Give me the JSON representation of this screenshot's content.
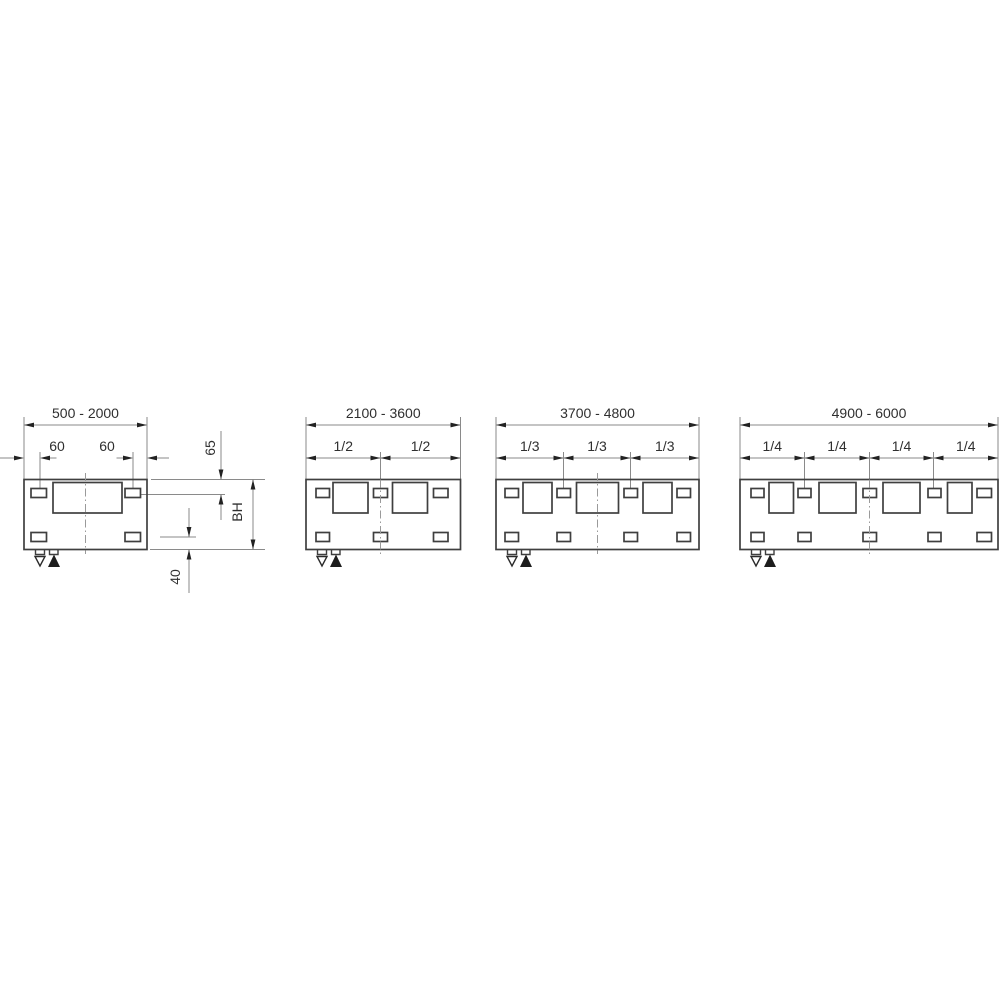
{
  "page": {
    "background": "#ffffff"
  },
  "style": {
    "geometry_color": "#3f3f3f",
    "dimension_line_color": "#8a8a8a",
    "arrow_color": "#222222",
    "text_color": "#2f2f2f",
    "centerline_color": "#9a9a9a"
  },
  "markers": {
    "open_down_triangle": "▽",
    "filled_up_triangle": "▲"
  },
  "diagrams": [
    {
      "name": "500-2000",
      "title": "500 - 2000",
      "plate": {
        "x1": 24,
        "x2": 147
      },
      "openings": [
        {
          "x": 53,
          "w": 69
        }
      ],
      "slots_top": [
        {
          "x": 31,
          "w": 15.5
        },
        {
          "x": 125,
          "w": 15.5
        }
      ],
      "slots_bottom": [
        {
          "x": 31,
          "w": 15.5
        },
        {
          "x": 125,
          "w": 15.5
        }
      ],
      "centerline_x": 85.5,
      "centerline_full": false,
      "boundaries": [],
      "span_labels": [],
      "offset_dim": {
        "labels": [
          "60",
          "60"
        ],
        "label_x": [
          57,
          107
        ],
        "verticals": [
          40,
          133
        ],
        "arrows": [
          {
            "dir": "right",
            "tip": 24,
            "tail": [
              0,
              14
            ]
          },
          {
            "dir": "left",
            "tip": 40,
            "tail": [
              50,
              56.5
            ]
          },
          {
            "dir": "right",
            "tip": 133,
            "tail": [
              116.5,
              123
            ]
          },
          {
            "dir": "left",
            "tip": 147,
            "tail": [
              157,
              169
            ]
          }
        ]
      },
      "side": {
        "ext_lines": [
          [
            151,
            479.5,
            265
          ],
          [
            141,
            494.5,
            225
          ],
          [
            160,
            537,
            196
          ],
          [
            150,
            549.5,
            265
          ]
        ],
        "dims": [
          {
            "label": "65",
            "x": 221,
            "text": [
              210,
              448
            ],
            "segs": [
              {
                "y1": 431,
                "y2": 479.5,
                "arrows": [
                  {
                    "dir": "down",
                    "y": 479.5
                  }
                ]
              },
              {
                "y1": 494.5,
                "y2": 520,
                "arrows": [
                  {
                    "dir": "up",
                    "y": 494.5
                  }
                ]
              }
            ]
          },
          {
            "label": "BH",
            "x": 253,
            "text": [
              237,
              512
            ],
            "segs": [
              {
                "y1": 479.5,
                "y2": 549.5,
                "arrows": [
                  {
                    "dir": "up",
                    "y": 479.5
                  },
                  {
                    "dir": "down",
                    "y": 549.5
                  }
                ]
              }
            ]
          },
          {
            "label": "40",
            "x": 189,
            "text": [
              175,
              577
            ],
            "segs": [
              {
                "y1": 508,
                "y2": 537,
                "arrows": [
                  {
                    "dir": "down",
                    "y": 537
                  }
                ]
              },
              {
                "y1": 549.5,
                "y2": 593,
                "arrows": [
                  {
                    "dir": "up",
                    "y": 549.5
                  }
                ]
              }
            ]
          }
        ]
      }
    },
    {
      "name": "2100-3600",
      "title": "2100 - 3600",
      "plate": {
        "x1": 306,
        "x2": 460.5
      },
      "openings": [
        {
          "x": 333,
          "w": 35
        },
        {
          "x": 392.5,
          "w": 35
        }
      ],
      "slots_top": [
        {
          "x": 316,
          "w": 13.5
        },
        {
          "x": 373.5,
          "w": 14
        },
        {
          "x": 433.5,
          "w": 14.5
        }
      ],
      "slots_bottom": [
        {
          "x": 316,
          "w": 13.5
        },
        {
          "x": 373.5,
          "w": 14
        },
        {
          "x": 433.5,
          "w": 14.5
        }
      ],
      "centerline_x": 380.5,
      "centerline_full": true,
      "boundaries": [
        380.5
      ],
      "span_labels": [
        "1/2",
        "1/2"
      ]
    },
    {
      "name": "3700-4800",
      "title": "3700 - 4800",
      "plate": {
        "x1": 496,
        "x2": 699
      },
      "openings": [
        {
          "x": 523,
          "w": 29
        },
        {
          "x": 576.5,
          "w": 42
        },
        {
          "x": 643,
          "w": 29
        }
      ],
      "slots_top": [
        {
          "x": 505,
          "w": 13.5
        },
        {
          "x": 557,
          "w": 13.5
        },
        {
          "x": 624,
          "w": 13.5
        },
        {
          "x": 677,
          "w": 13.5
        }
      ],
      "slots_bottom": [
        {
          "x": 505,
          "w": 13.5
        },
        {
          "x": 557,
          "w": 13.5
        },
        {
          "x": 624,
          "w": 13.5
        },
        {
          "x": 677,
          "w": 13.5
        }
      ],
      "centerline_x": 597.5,
      "centerline_full": false,
      "boundaries": [
        563.5,
        630.5
      ],
      "span_labels": [
        "1/3",
        "1/3",
        "1/3"
      ]
    },
    {
      "name": "4900-6000",
      "title": "4900 - 6000",
      "plate": {
        "x1": 740,
        "x2": 998
      },
      "openings": [
        {
          "x": 769,
          "w": 24.5
        },
        {
          "x": 819,
          "w": 37
        },
        {
          "x": 883,
          "w": 37
        },
        {
          "x": 947.5,
          "w": 24.5
        }
      ],
      "slots_top": [
        {
          "x": 751,
          "w": 13
        },
        {
          "x": 798,
          "w": 13
        },
        {
          "x": 863,
          "w": 13.5
        },
        {
          "x": 928,
          "w": 13
        },
        {
          "x": 977,
          "w": 14.5
        }
      ],
      "slots_bottom": [
        {
          "x": 751,
          "w": 13
        },
        {
          "x": 798,
          "w": 13
        },
        {
          "x": 863,
          "w": 13.5
        },
        {
          "x": 928,
          "w": 13
        },
        {
          "x": 977,
          "w": 14.5
        }
      ],
      "centerline_x": 869.5,
      "centerline_full": true,
      "boundaries": [
        804.5,
        869.5,
        933.5
      ],
      "span_labels": [
        "1/4",
        "1/4",
        "1/4",
        "1/4"
      ]
    }
  ]
}
